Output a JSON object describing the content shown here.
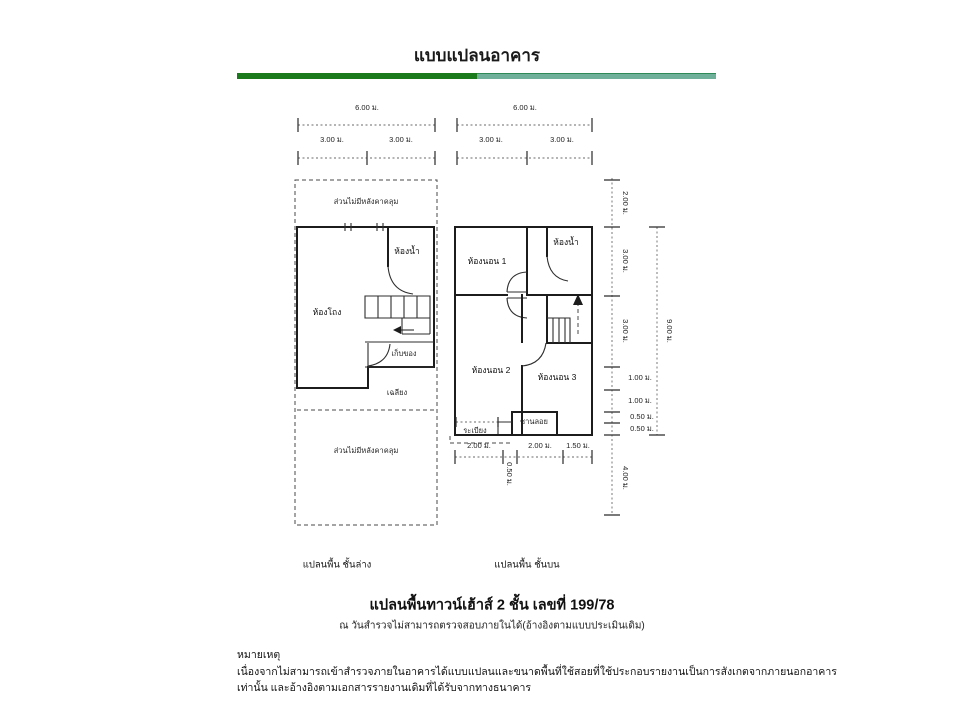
{
  "page": {
    "title": "แบบแปลนอาคาร"
  },
  "divider": {
    "left_color": "#1b7a1b",
    "right_color": "#6fb09a"
  },
  "dims": {
    "ground_total": "6.00 ม.",
    "ground_left": "3.00 ม.",
    "ground_right": "3.00 ม.",
    "upper_total": "6.00 ม.",
    "upper_left": "3.00 ม.",
    "upper_right": "3.00 ม.",
    "right_chain": [
      "2.00 ม.",
      "3.00 ม.",
      "3.00 ม.",
      "1.00 ม.",
      "1.00 ม.",
      "0.50 ม.",
      "0.50 ม.",
      "4.00 ม."
    ],
    "right_total": "9.00 ม.",
    "bottom": [
      "2.00 ม.",
      "0.50 ม.",
      "2.00 ม.",
      "1.50 ม."
    ]
  },
  "ground_floor": {
    "caption": "แปลนพื้น ชั้นล่าง",
    "front_area": "ส่วนไม่มีหลังคาคลุม",
    "bathroom": "ห้องน้ำ",
    "hall": "ห้องโถง",
    "storage": "เก็บของ",
    "porch": "เฉลียง",
    "rear_area": "ส่วนไม่มีหลังคาคลุม"
  },
  "upper_floor": {
    "caption": "แปลนพื้น ชั้นบน",
    "bedroom1": "ห้องนอน 1",
    "bathroom": "ห้องน้ำ",
    "bedroom2": "ห้องนอน 2",
    "bedroom3": "ห้องนอน 3",
    "deck": "ชานลอย",
    "balcony": "ระเบียง"
  },
  "caption": {
    "title": "แปลนพื้นทาวน์เฮ้าส์ 2 ชั้น เลขที่ 199/78",
    "subtitle": "ณ วันสำรวจไม่สามารถตรวจสอบภายในได้(อ้างอิงตามแบบประเมินเดิม)"
  },
  "note": {
    "heading": "หมายเหตุ",
    "line1": "เนื่องจากไม่สามารถเข้าสำรวจภายในอาคารได้แบบแปลนและขนาดพื้นที่ใช้สอยที่ใช้ประกอบรายงานเป็นการสังเกตจากภายนอกอาคาร",
    "line2": "เท่านั้น และอ้างอิงตามเอกสารรายงานเดิมที่ได้รับจากทางธนาคาร"
  }
}
